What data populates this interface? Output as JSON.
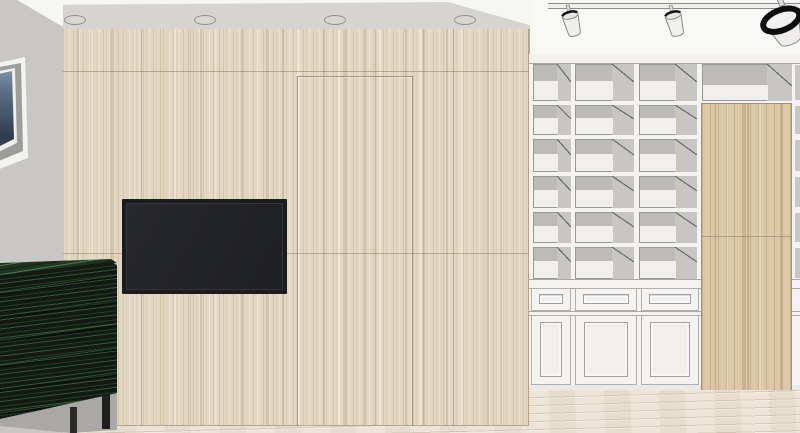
{
  "meta": {
    "title": "Interior design 3D render",
    "view": "Living room elevation: wood feature TV wall with concealed door, built-in white bookshelf, green sideboard",
    "style": "SketchUp-like line render",
    "width": 800,
    "height": 433
  },
  "objects": [
    {
      "name": "ceiling-soffit",
      "detail": "grey cove soffit above wood wall",
      "downlight_count": 4
    },
    {
      "name": "track-light",
      "detail": "ceiling track rail with 3 white spotlights, rightmost seen close-up with black rim"
    },
    {
      "name": "framed-artwork",
      "detail": "white frame, grey mat, dark blue image, partially cut by left edge"
    },
    {
      "name": "wood-feature-wall",
      "material": "light oak veneer, vertical grain, panel seams"
    },
    {
      "name": "concealed-door-outline",
      "location": "wood feature wall, right of TV"
    },
    {
      "name": "wall-mounted-tv",
      "state": "off, black screen"
    },
    {
      "name": "green-sideboard",
      "material": "dark green/black stained wood, thin black legs"
    },
    {
      "name": "built-in-bookshelf",
      "detail": "white open shelving, 6 rows; base of 3 drawers over 3 panel doors"
    },
    {
      "name": "bookshelf-wood-door-panel",
      "detail": "tall wood concealed door inset in right side of shelving"
    },
    {
      "name": "wood-floor",
      "material": "pale wood planks"
    }
  ],
  "palette": {
    "sideWall": "#c8c7c5",
    "ceilingWhite": "#f6f6f4",
    "ceilingRight": "#f8f8f6",
    "soffit": "#d5d4d2",
    "soffitEdge": "#8f8e8c",
    "woodBase": "#e2d7c3",
    "doorWoodBase": "#d9c7a7",
    "woodSeam": "#9b8a6e",
    "tvBezel": "#1b1c1e",
    "tvScreen": "#242528",
    "shelfWhite": "#f4f3f1",
    "cellGrey": "#bcbbb8",
    "cellGreyRight": "#c7c6c3",
    "cellBack": "#f0efed",
    "cabinetBlack": "#141914",
    "cabinetTop": "#223522",
    "legDark": "#1f1f1d",
    "shadowGrey": "#a9a8a6",
    "floorBase": "#ece5d7",
    "railLine": "#8c8b89",
    "picFrame": "#f3f3f1",
    "picMat": "#9e9d9b",
    "picImage": "#4a5a6e"
  },
  "layout": {
    "floorY": 384,
    "wall": {
      "x": 63,
      "y": 28,
      "w": 466,
      "h": 397
    },
    "wallSeamsV": [
      141,
      219,
      375,
      453
    ],
    "wallSeamsH": [
      70,
      252
    ],
    "hiddenDoor": {
      "x": 297,
      "y": 75,
      "w": 116,
      "h": 350
    },
    "tv": {
      "x": 122,
      "y": 199,
      "w": 165,
      "h": 95
    },
    "downlights": [
      75,
      205,
      335,
      465
    ],
    "downlightY": 20,
    "shelf": {
      "x": 529,
      "y": 54,
      "w": 271,
      "h": 336,
      "cols": [
        {
          "x": 533,
          "w": 38
        },
        {
          "x": 575,
          "w": 59
        },
        {
          "x": 639,
          "w": 58
        }
      ],
      "rows": [
        {
          "y": 64,
          "h": 37
        },
        {
          "y": 105,
          "h": 30
        },
        {
          "y": 139,
          "h": 33
        },
        {
          "y": 176,
          "h": 32
        },
        {
          "y": 212,
          "h": 31
        },
        {
          "y": 247,
          "h": 32
        }
      ],
      "wideCell": {
        "x": 702,
        "w": 90
      },
      "rightStrip": {
        "x": 795,
        "w": 5
      },
      "woodDoor": {
        "x": 701,
        "y": 103,
        "w": 91,
        "h": 287,
        "seamY": 235
      },
      "base": {
        "lines": [
          279,
          288,
          311,
          315,
          385
        ],
        "drawerY": 288,
        "drawerH": 23,
        "doorY": 315,
        "doorH": 70,
        "plinthY": 385,
        "bottomY": 390,
        "fronts": [
          {
            "x": 531,
            "w": 40
          },
          {
            "x": 575,
            "w": 62
          },
          {
            "x": 641,
            "w": 58
          }
        ]
      }
    },
    "cabinet": {
      "x": 0,
      "y": 256,
      "w": 118,
      "h": 177
    },
    "picture": {
      "x": -6,
      "y": 56,
      "w": 35,
      "h": 117
    }
  }
}
